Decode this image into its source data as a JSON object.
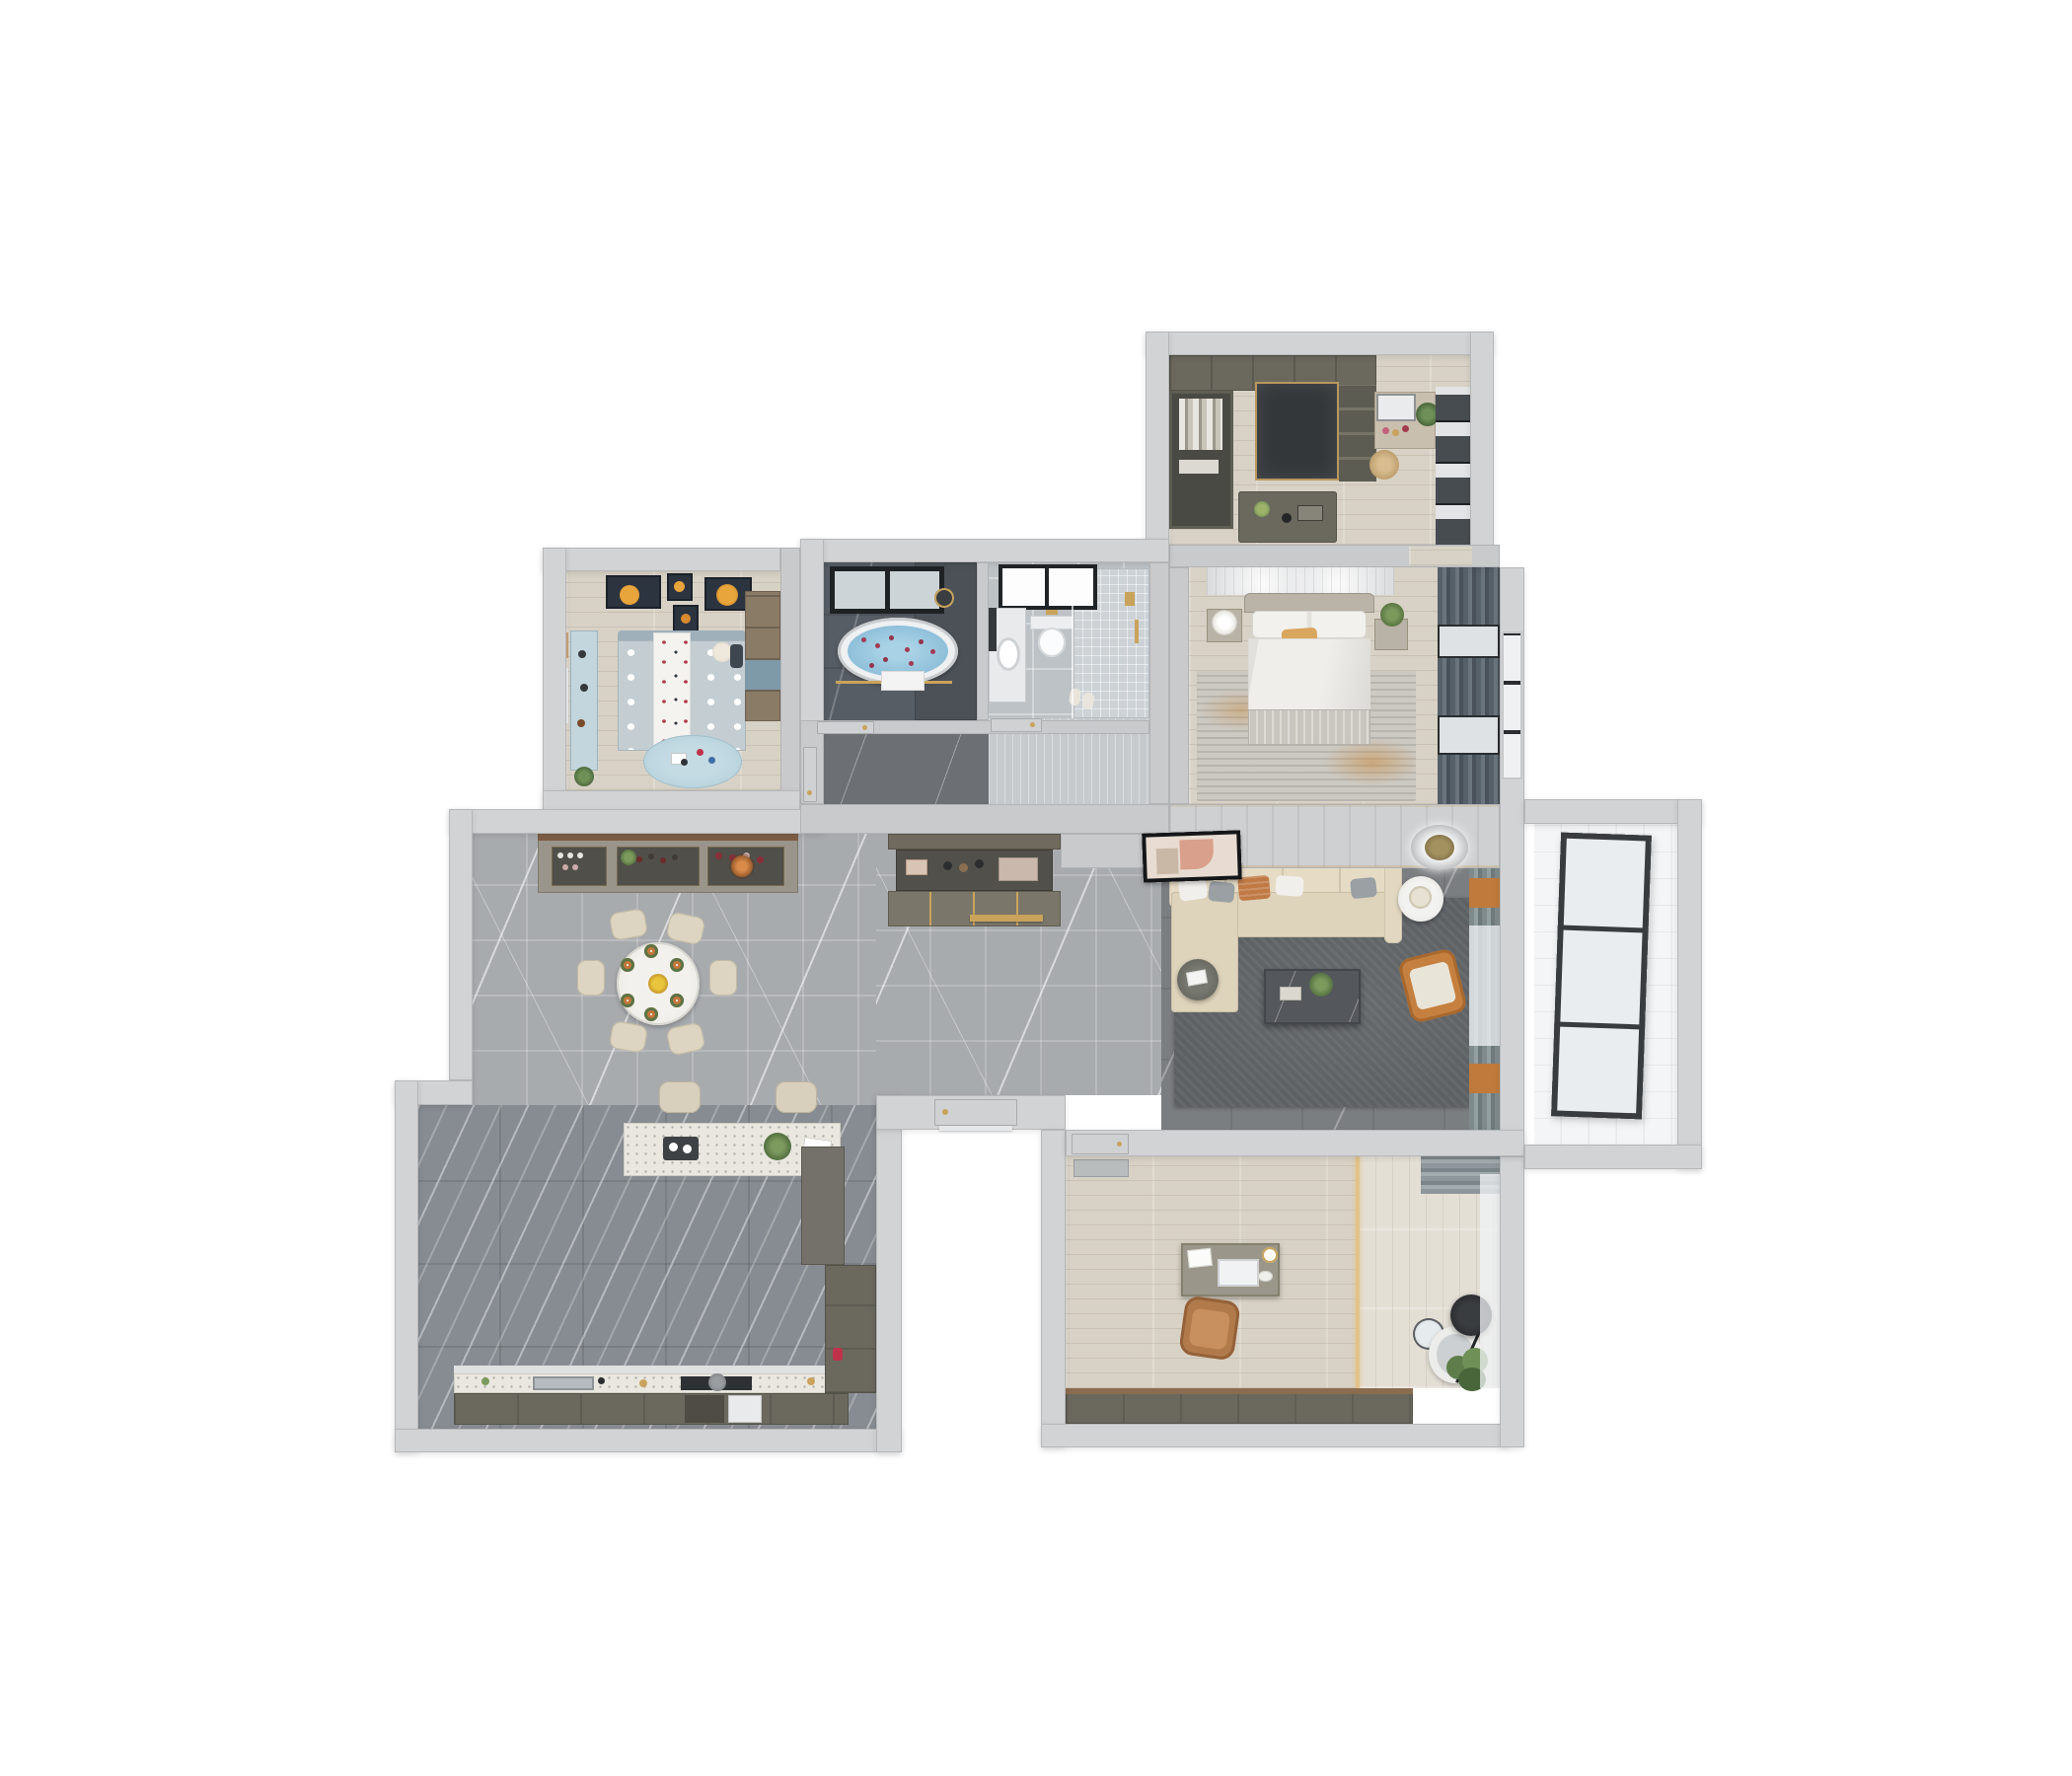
{
  "scene": {
    "title": "3D top-view apartment floor plan render",
    "description": "Photoreal dollhouse view of a furnished apartment seen from directly above",
    "background": "#ffffff",
    "visible_text": []
  },
  "palette": {
    "outer_wall": "#d2d3d5",
    "inner_wall": "#c9cacc",
    "wall_edge": "#b7b8ba",
    "wood_floor": "#d8d2c6",
    "wood_floor_light": "#e4dfd5",
    "marble_light_grey": "#a8abae",
    "marble_dark_grey": "#878c92",
    "living_floor": "#7b7e81",
    "bath_dark_tile": "#575d64",
    "bath_light_tile": "#bdc2c6",
    "balcony_tile": "#f4f5f6",
    "cabinet_olive": "#6b695e",
    "sofa_cream": "#e2d8c2",
    "accent_orange": "#c5803f",
    "accent_rust_pillow": "#c07a45",
    "accent_gold": "#c9a35c",
    "curtain_navy": "#42536b",
    "curtain_slate": "#566069",
    "curtain_green_grey": "#7e8a8c",
    "bath_water": "#8fc0da",
    "rose_petals": "#a23b52",
    "rug_living": "#5d6164",
    "rug_master_orange": "#c98b3f",
    "kids_blue": "#b7d2dc",
    "red_kettle": "#c0314a"
  },
  "rooms": [
    {
      "name": "Walk-in closet and vanity room",
      "floor": "light wood planks",
      "furniture": [
        "wardrobe run",
        "open wardrobe with hanging clothes",
        "dark glass wardrobe",
        "shelf unit",
        "center island dresser with decor",
        "dressing table with mirror",
        "potted plant",
        "woven rattan basket",
        "dark roller blinds"
      ]
    },
    {
      "name": "Master bedroom",
      "floor": "light wood planks",
      "furniture": [
        "double bed with white duvet",
        "headboard slat panel",
        "tan accent pillow",
        "left nightstand with drum lamp",
        "right nightstand with plant",
        "distressed grey-orange rug",
        "slate curtains and windows"
      ]
    },
    {
      "name": "Master bathroom",
      "floor": "dark grey marble tile",
      "furniture": [
        "freestanding oval bathtub with rose petals",
        "black framed window",
        "shower head",
        "gold towel bar with white towel",
        "glass screen"
      ]
    },
    {
      "name": "Guest bathroom",
      "floor": "light grey tile",
      "furniture": [
        "wall-hung toilet",
        "vanity counter with basin and mirror",
        "walk-in shower with mosaic floor",
        "black framed window",
        "gold fixtures",
        "slippers"
      ]
    },
    {
      "name": "Hallway",
      "floor": "dark marble",
      "furniture": [
        "bathroom door",
        "bathroom door",
        "kids room door"
      ]
    },
    {
      "name": "Kids bedroom",
      "floor": "light wood planks",
      "furniture": [
        "polka-dot bed with runner",
        "teddy bear",
        "space-themed posters",
        "navy curtains with tan blinds",
        "light blue desk cabinet",
        "wardrobe",
        "round play rug with toys",
        "plant"
      ]
    },
    {
      "name": "Dining area",
      "floor": "light grey marble tile",
      "furniture": [
        "round dining table with six place settings",
        "six cream chairs",
        "yellow flower centerpiece",
        "wine and china cabinet",
        "copper pendant",
        "floor-to-ceiling windows"
      ]
    },
    {
      "name": "Foyer",
      "floor": "light grey marble tile",
      "furniture": [
        "shoe cabinet partition with open shelves",
        "gold floor inlay strip",
        "master bedroom door",
        "entrance door"
      ]
    },
    {
      "name": "Kitchen",
      "floor": "dark diagonal-vein marble tile",
      "furniture": [
        "terrazzo island with plant and tray",
        "two bar stools",
        "counter with sink and cooktop",
        "olive base cabinets",
        "tall pantry cabinets",
        "red kettle",
        "window wall"
      ]
    },
    {
      "name": "Living room",
      "floor": "dark grey marble",
      "furniture": [
        "L-shaped cream sectional sofa",
        "throw pillows",
        "abstract art frame",
        "round white side table with lamp",
        "dark round side table",
        "dark marble coffee table with plant",
        "orange leather armchair",
        "large grey rug",
        "round ceiling light",
        "green-grey curtains with orange accents"
      ]
    },
    {
      "name": "Study office",
      "floor": "light wood planks",
      "furniture": [
        "writing desk with computer and cup",
        "caramel office chair",
        "lounge chair",
        "black arc floor lamp",
        "round glass side table",
        "potted plant",
        "low olive cabinet",
        "doormat",
        "grey curtain and sheers"
      ]
    },
    {
      "name": "Balcony",
      "floor": "white tile",
      "furniture": [
        "large black-framed glazing panel"
      ]
    }
  ]
}
